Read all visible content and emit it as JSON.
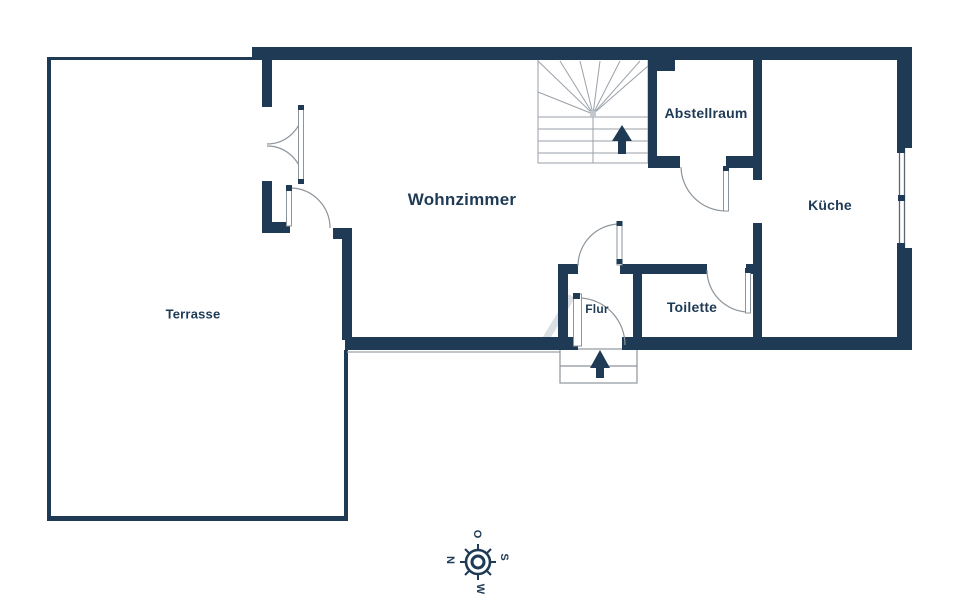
{
  "title": "Grundriss Erdgeschoss",
  "colors": {
    "wall": "#1e3a54",
    "text": "#1e3a55",
    "door_line": "#8d959c",
    "stair_line": "#9aa2a9",
    "background": "#ffffff"
  },
  "rooms": [
    {
      "id": "terrasse",
      "label": "Terrasse"
    },
    {
      "id": "wohnzimmer",
      "label": "Wohnzimmer"
    },
    {
      "id": "abstellraum",
      "label": "Abstellraum"
    },
    {
      "id": "kueche",
      "label": "Küche"
    },
    {
      "id": "flur",
      "label": "Flur"
    },
    {
      "id": "toilette",
      "label": "Toilette"
    }
  ],
  "compass": {
    "north": "N",
    "east": "O",
    "south": "S",
    "west": "W"
  },
  "symbols": [
    "stairs-up-arrow",
    "entrance-up-arrow",
    "window-right-wall",
    "double-french-door-terrace",
    "compass-rose"
  ]
}
